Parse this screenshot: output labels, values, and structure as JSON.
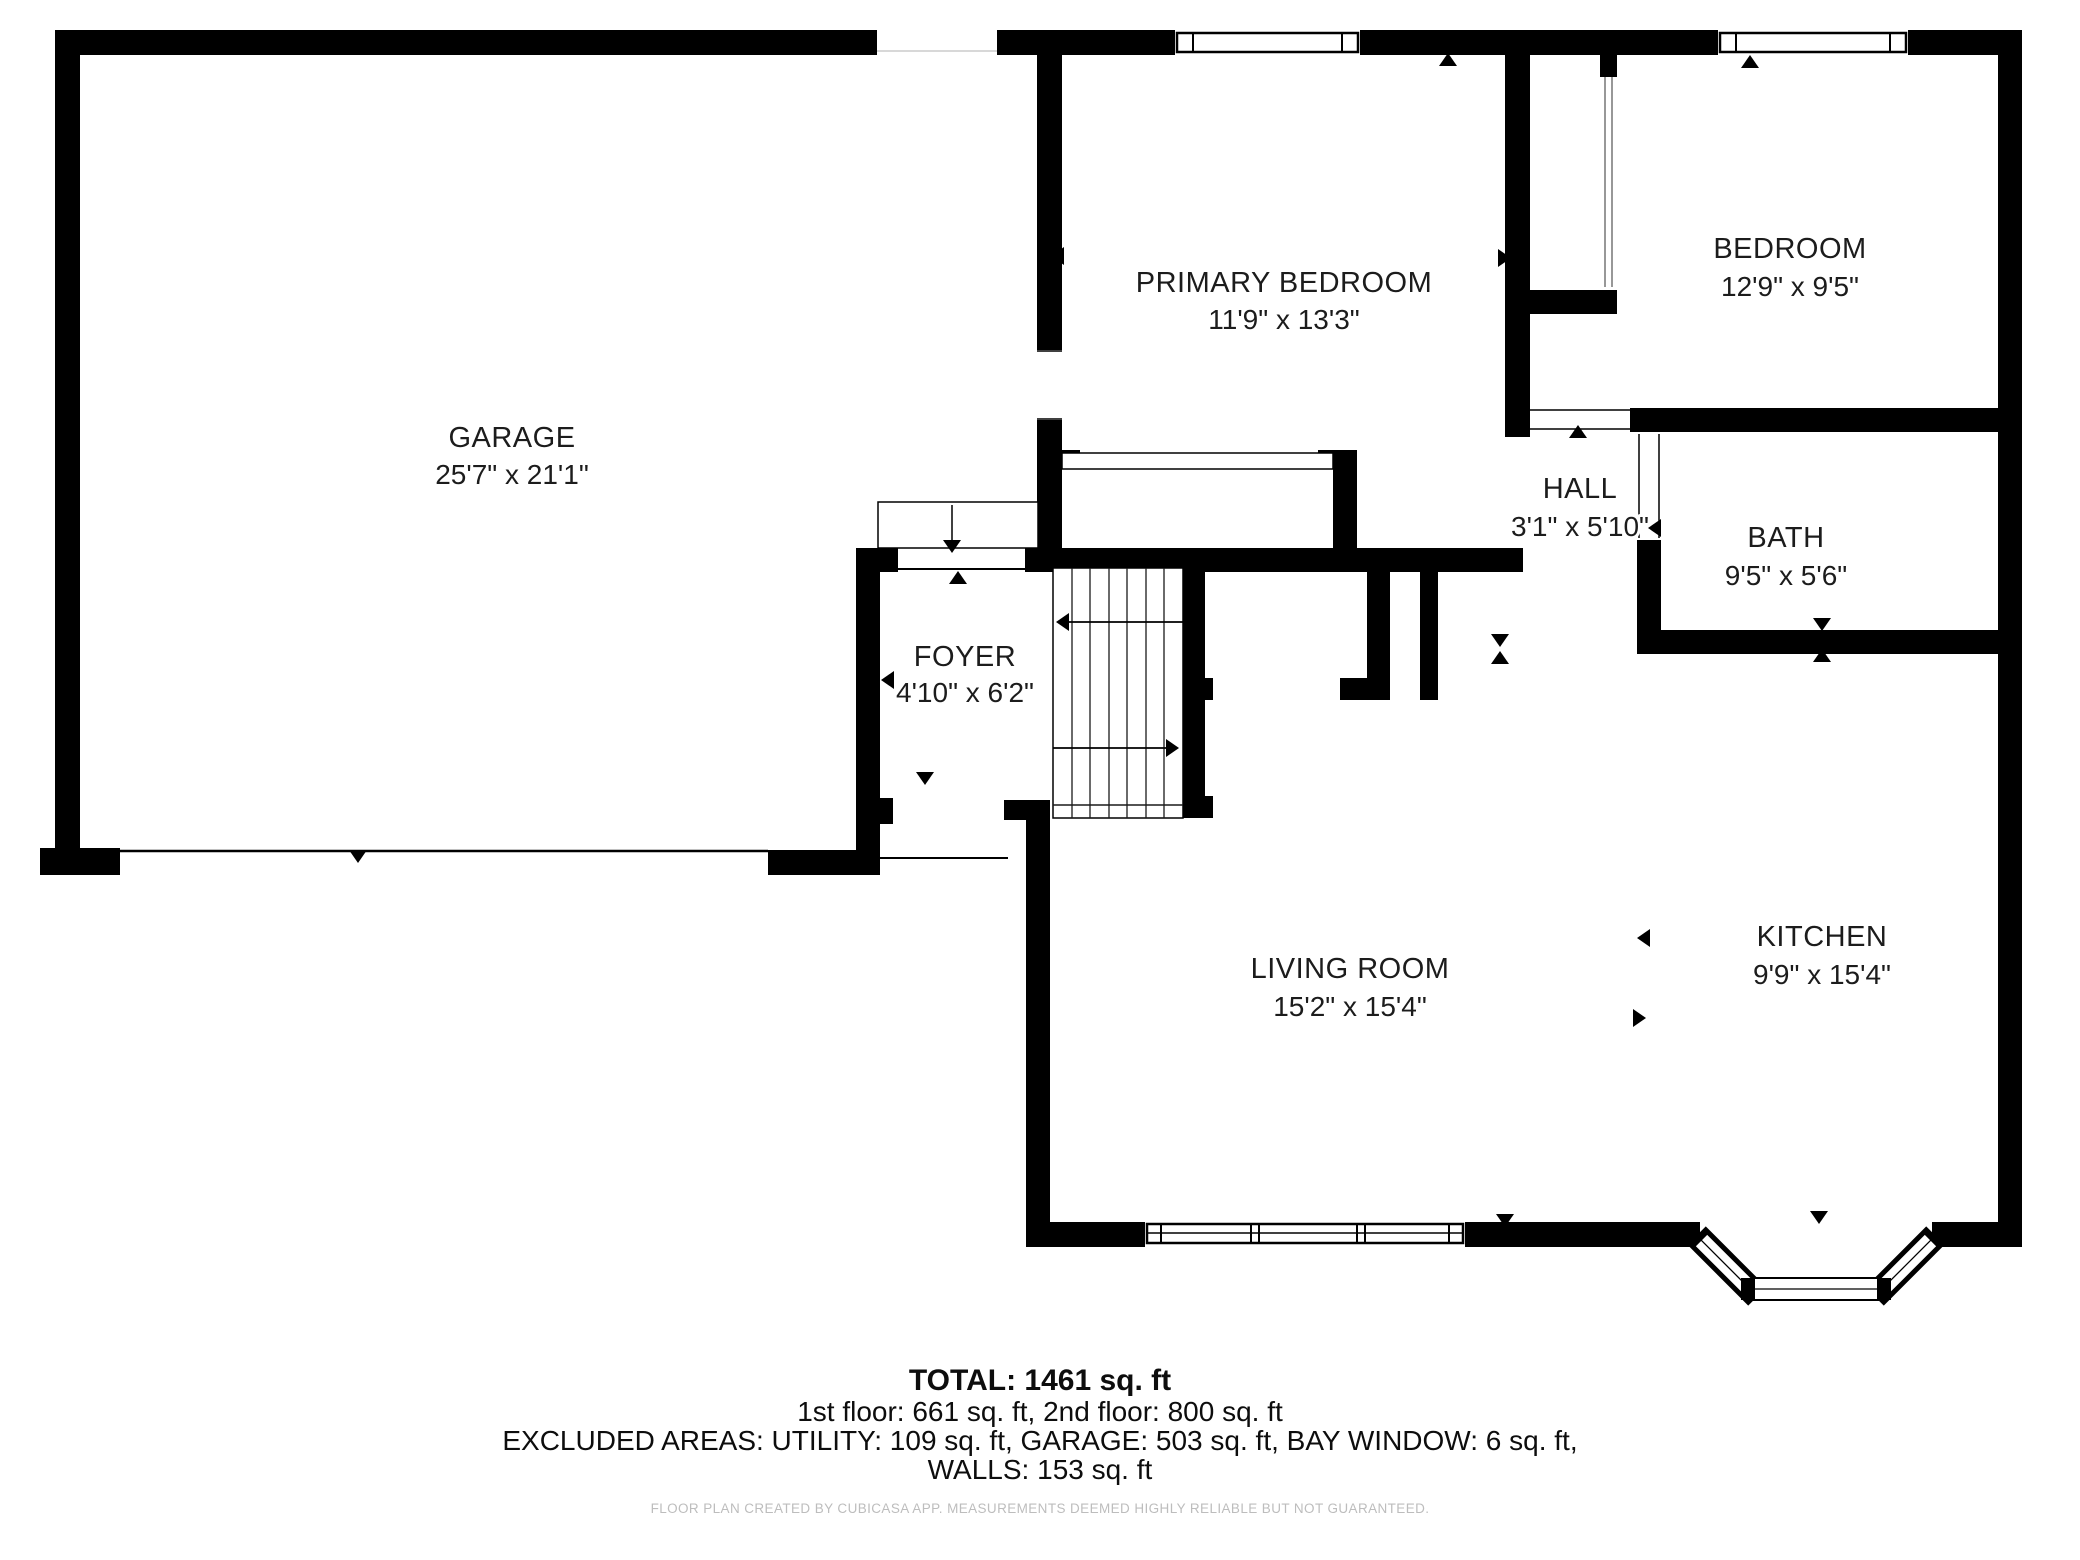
{
  "rooms": [
    {
      "id": "garage",
      "name": "GARAGE",
      "dims": "25'7\" x 21'1\""
    },
    {
      "id": "primary-bedroom",
      "name": "PRIMARY BEDROOM",
      "dims": "11'9\" x 13'3\""
    },
    {
      "id": "bedroom",
      "name": "BEDROOM",
      "dims": "12'9\" x 9'5\""
    },
    {
      "id": "hall",
      "name": "HALL",
      "dims": "3'1\" x 5'10\""
    },
    {
      "id": "bath",
      "name": "BATH",
      "dims": "9'5\" x 5'6\""
    },
    {
      "id": "foyer",
      "name": "FOYER",
      "dims": "4'10\" x 6'2\""
    },
    {
      "id": "living-room",
      "name": "LIVING ROOM",
      "dims": "15'2\" x 15'4\""
    },
    {
      "id": "kitchen",
      "name": "KITCHEN",
      "dims": "9'9\" x 15'4\""
    }
  ],
  "summary": {
    "total": "TOTAL: 1461 sq. ft",
    "floors": "1st floor: 661 sq. ft, 2nd floor: 800 sq. ft",
    "excluded": "EXCLUDED AREAS: UTILITY: 109 sq. ft, GARAGE: 503 sq. ft, BAY WINDOW: 6 sq. ft,",
    "walls": "WALLS: 153 sq. ft"
  },
  "footer": {
    "disclaimer": "FLOOR PLAN CREATED BY CUBICASA APP. MEASUREMENTS DEEMED HIGHLY RELIABLE BUT NOT GUARANTEED."
  },
  "colors": {
    "wall": "#000000",
    "background": "#ffffff",
    "label": "#1c1c1c",
    "footer_text": "#bdbdbd"
  }
}
